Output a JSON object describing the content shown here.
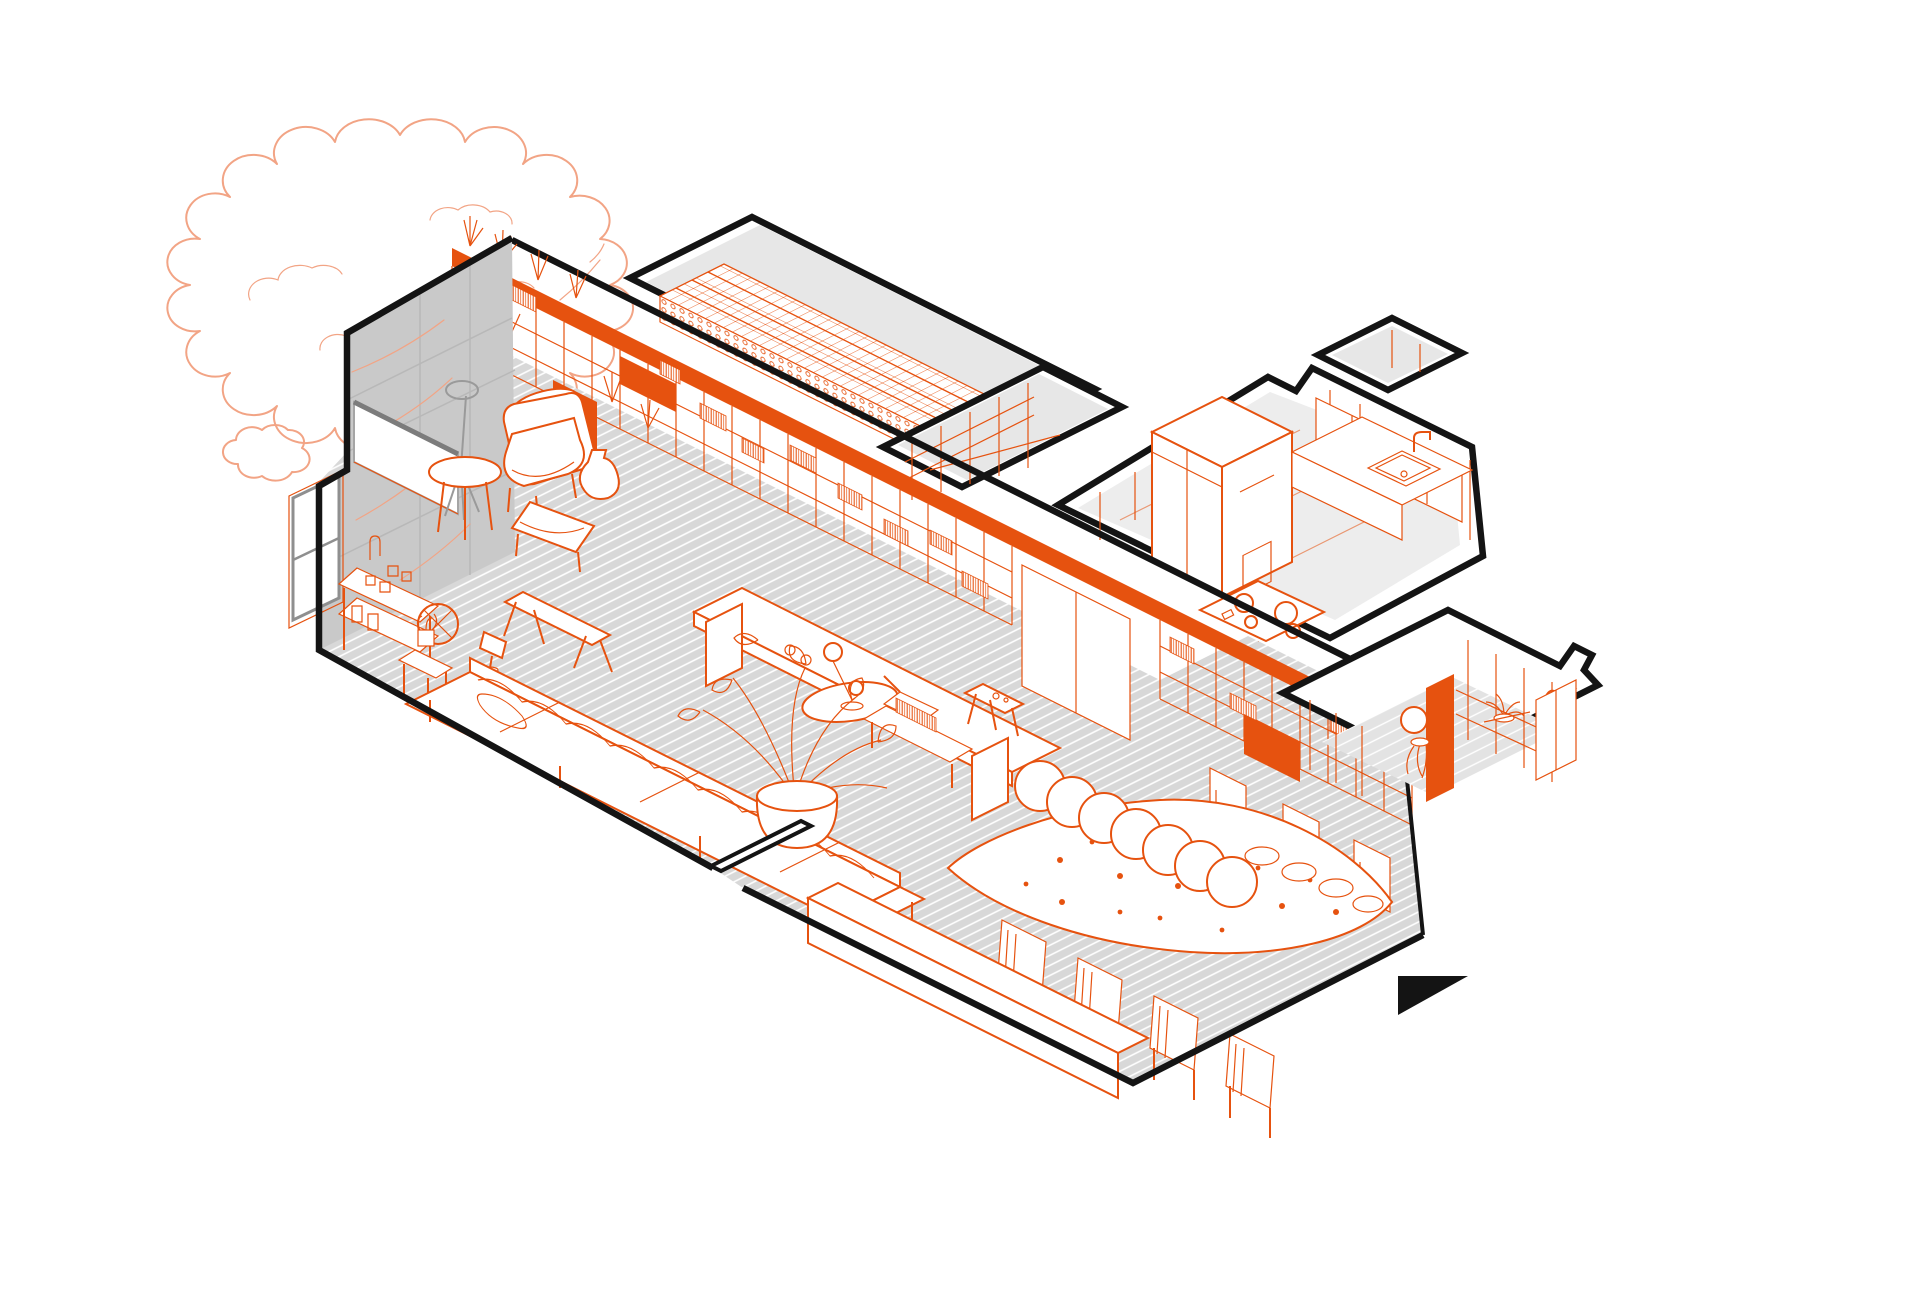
{
  "drawing": {
    "title": "Apartment axonometric cutaway drawing",
    "type": "architectural-axonometric",
    "style": "orange line work on white with gray floors and thick black cut walls",
    "view_marker": "solid black triangle pointer at lower right"
  },
  "colors": {
    "orange": "#E6520F",
    "salmon": "#F2A485",
    "black": "#141414",
    "wall_gray": "#C9C9C9",
    "floor_gray": "#D8D8D8",
    "paper": "#FFFFFF"
  },
  "exterior": {
    "tree": "deciduous tree drawn as light salmon outline behind the left wall"
  },
  "rooms": [
    {
      "id": "living-room",
      "label": "open living area with window wall and long bookshelf wall"
    },
    {
      "id": "dining-area",
      "label": "dining area with organic table on hatched gray floor"
    },
    {
      "id": "storage-room",
      "label": "long storage room with wine rack"
    },
    {
      "id": "hallway",
      "label": "small hallway with open shelving"
    },
    {
      "id": "kitchen",
      "label": "kitchen with tall cabinet, sink counter and cooktop"
    },
    {
      "id": "back-room",
      "label": "rear room with wardrobe shelving, mirror and orange door"
    }
  ],
  "living_room": {
    "furniture": [
      "armchair",
      "ottoman",
      "round side table",
      "tripod floor lamp",
      "bar cart with bottles",
      "flower side table",
      "table lamp",
      "long sofa with chaise",
      "low work table with tray and laptop",
      "console table with books",
      "wooden bench",
      "ball floor lamp",
      "potted monstera plant",
      "stool",
      "roller blind",
      "window",
      "bookshelf wall with plants and tv panel"
    ]
  },
  "dining_area": {
    "furniture": [
      "organic triangular dining table",
      "stacked plates",
      "long low sideboard bench"
    ],
    "plate_stack_count": 7,
    "table_plate_count": 4,
    "chairs_south": 4,
    "chairs_north": 3
  },
  "kitchen": {
    "fixtures": [
      "tall cabinet volume",
      "upper cabinets",
      "counter with sink and faucet",
      "cooktop with four burners"
    ]
  },
  "storage_room": {
    "fixtures": [
      "wine rack grid",
      "white counter",
      "open shelving"
    ]
  },
  "hallway": {
    "fixtures": [
      "open shelf posts"
    ]
  },
  "back_room": {
    "fixtures": [
      "orange door panel",
      "round mirror",
      "hanging plant",
      "closet volume",
      "shelf with plant",
      "bird figurine"
    ]
  },
  "marker": {
    "shape": "right-angled triangle",
    "color": "#141414"
  }
}
